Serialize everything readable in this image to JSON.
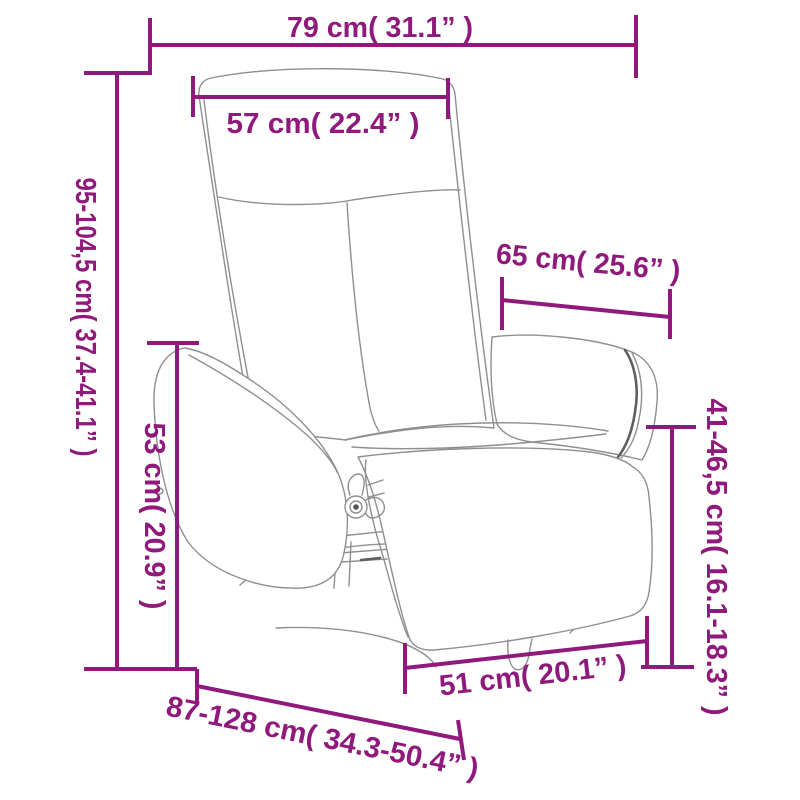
{
  "page": {
    "background": "#ffffff",
    "accent_color": "#8F1A7B",
    "drawing_line_color": "#8f8f8f"
  },
  "diagram": {
    "subject": "recliner-chair-with-footrest-line-drawing",
    "dimensions": {
      "width_overall": "79 cm( 31.1” )",
      "width_backrest": "57 cm( 22.4” )",
      "height_overall": "95-104,5 cm( 37.4-41.1” )",
      "height_armrest": "53 cm( 20.9” )",
      "width_seatback": "65 cm( 25.6” )",
      "height_footrest": "41-46,5 cm( 16.1-18.3” )",
      "width_footrest": "51 cm( 20.1” )",
      "depth_overall": "87-128 cm( 34.3-50.4” )"
    }
  }
}
